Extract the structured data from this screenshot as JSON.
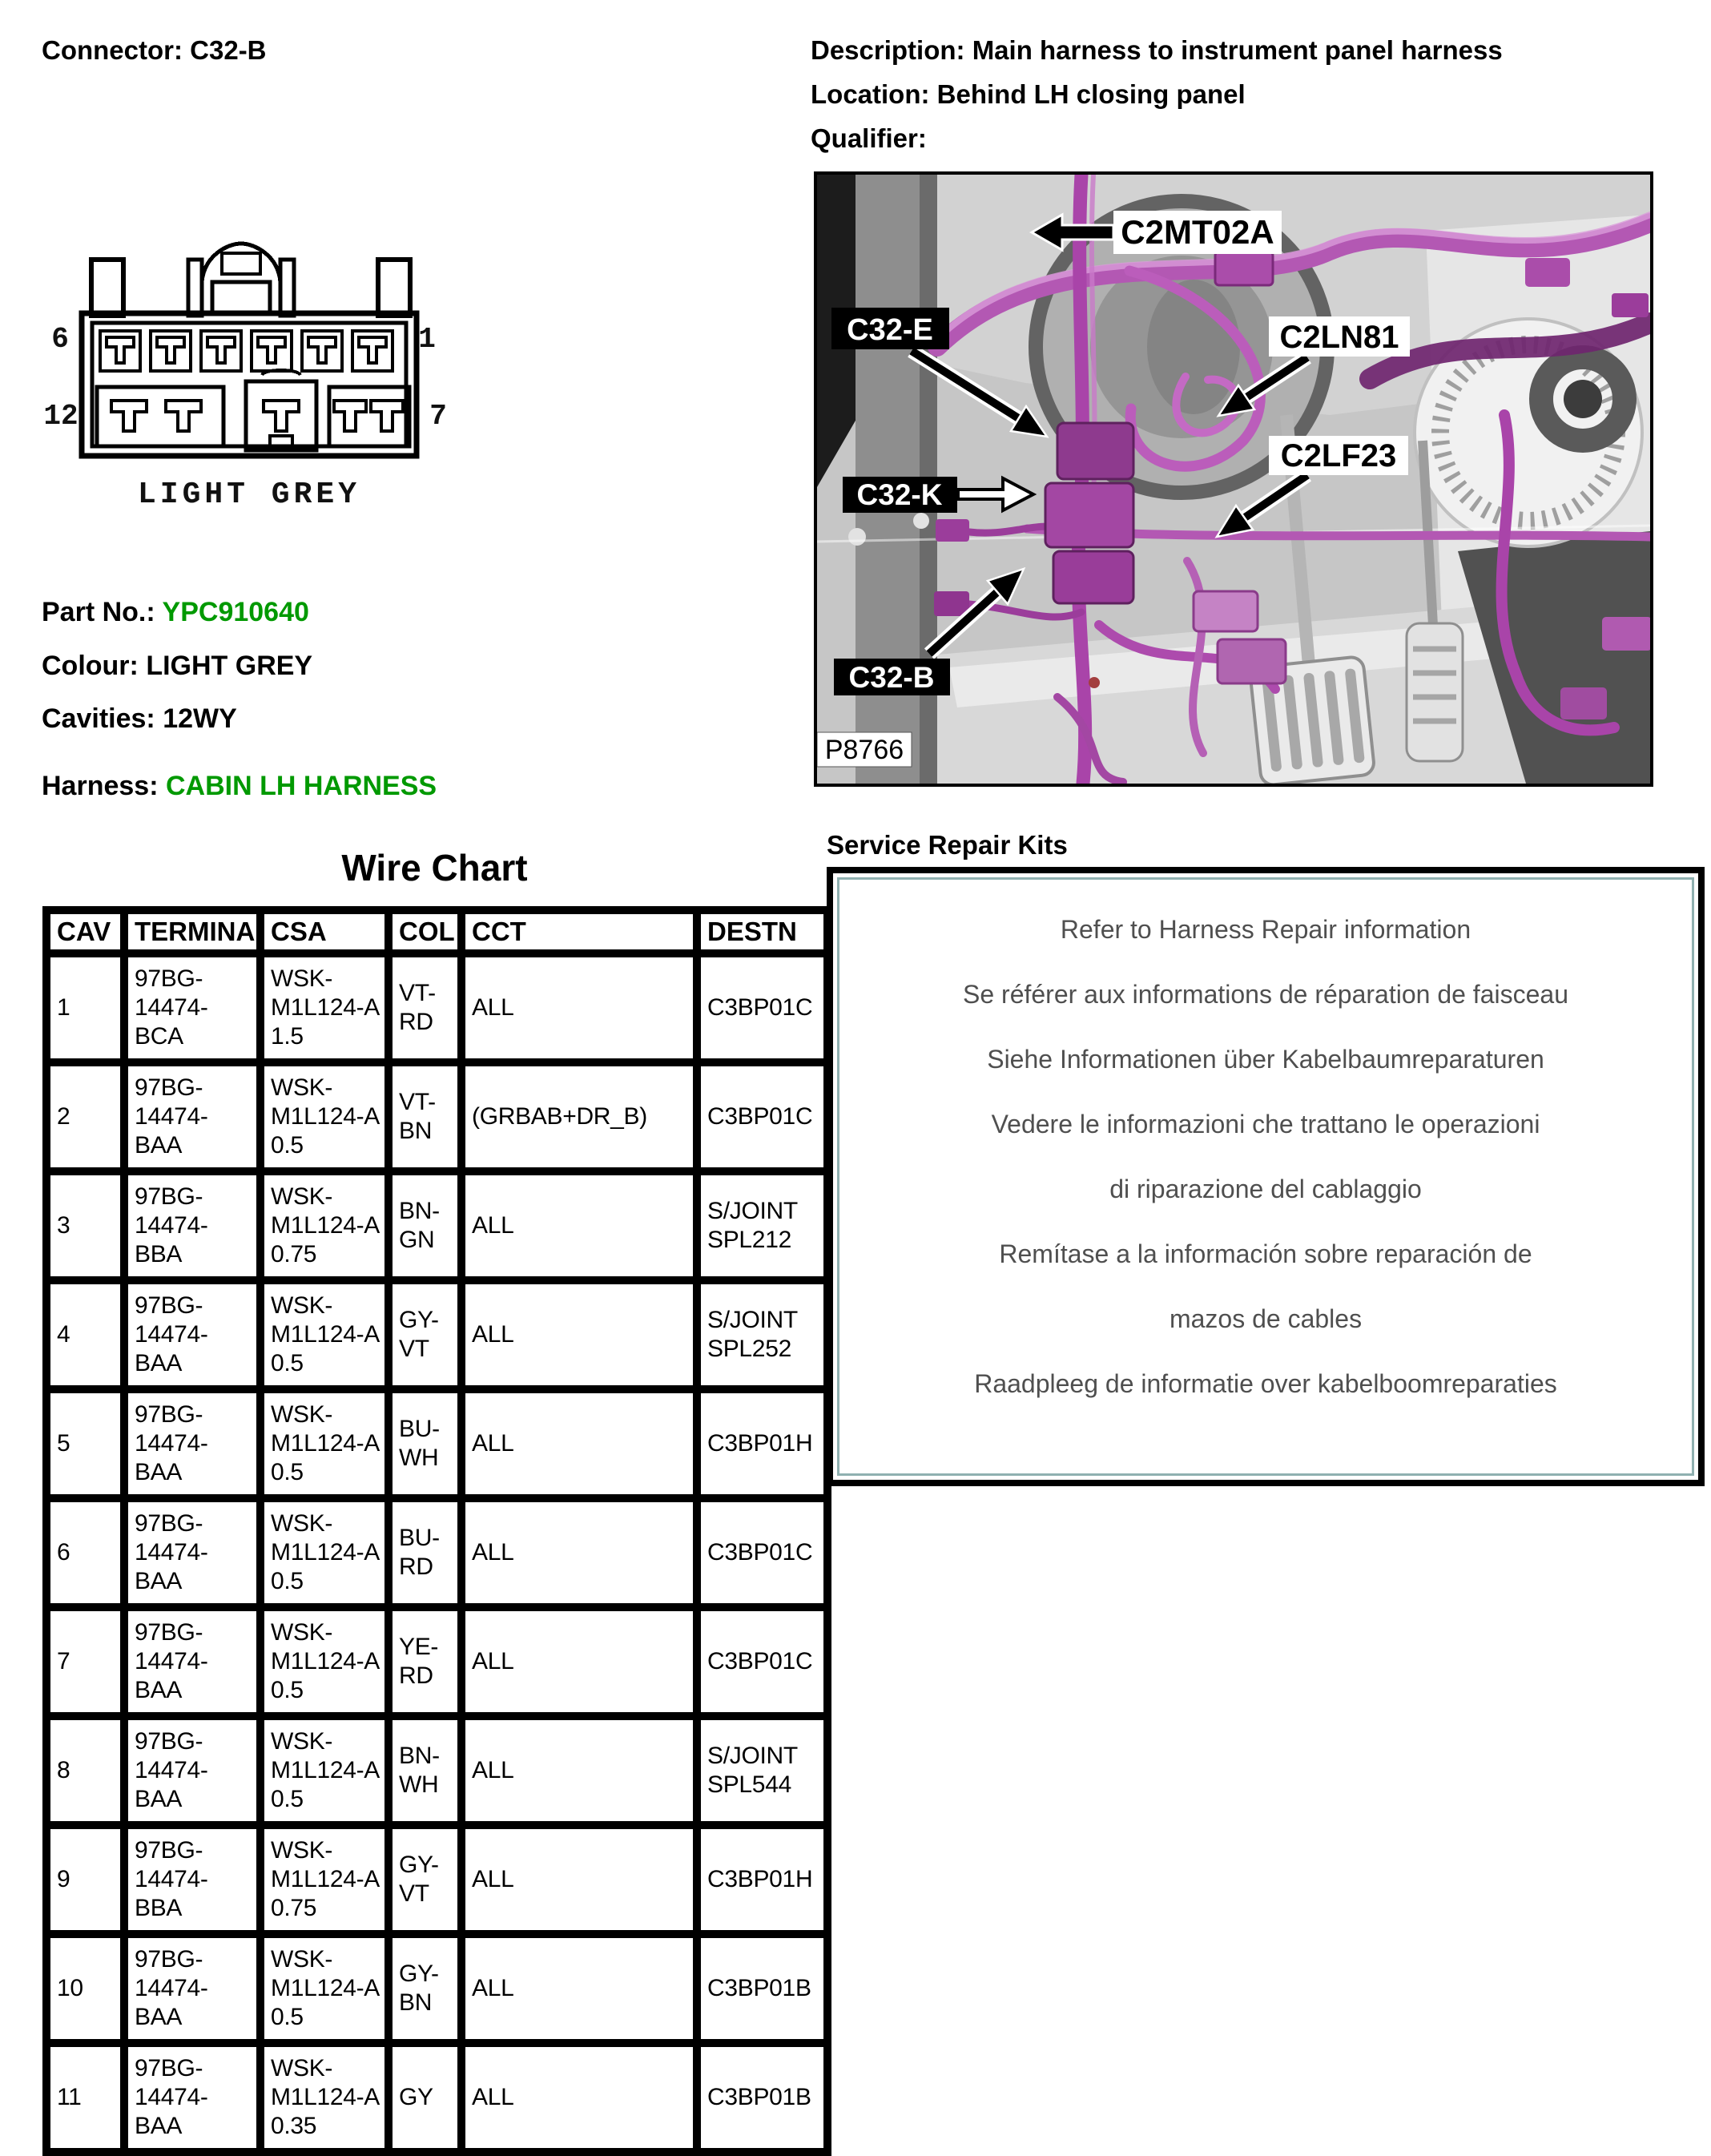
{
  "header": {
    "connector": "Connector: C32-B",
    "description": "Description: Main harness to instrument panel harness",
    "location": "Location: Behind LH closing panel",
    "qualifier": "Qualifier:"
  },
  "connector_diagram": {
    "pins": {
      "top_left": "6",
      "top_right": "1",
      "bottom_left": "12",
      "bottom_right": "7"
    },
    "colour": "LIGHT GREY"
  },
  "part_info": {
    "part_label": "Part No.:",
    "part_value": "YPC910640",
    "colour_label": "Colour:",
    "colour_value": "LIGHT GREY",
    "cavities_label": "Cavities:",
    "cavities_value": "12WY",
    "harness_label": "Harness:",
    "harness_value": "CABIN LH HARNESS"
  },
  "photo": {
    "figure_id": "P8766",
    "callouts": [
      {
        "label": "C2MT02A"
      },
      {
        "label": "C32-E"
      },
      {
        "label": "C2LN81"
      },
      {
        "label": "C2LF23"
      },
      {
        "label": "C32-K"
      },
      {
        "label": "C32-B"
      }
    ]
  },
  "wire_chart": {
    "title": "Wire Chart",
    "headers": [
      "CAV",
      "TERMINAL",
      "CSA",
      "COL",
      "CCT",
      "DESTN"
    ],
    "rows": [
      [
        "1",
        "97BG-14474-BCA",
        "WSK-M1L124-A 1.5",
        "VT-RD",
        "ALL",
        "C3BP01C"
      ],
      [
        "2",
        "97BG-14474-BAA",
        "WSK-M1L124-A 0.5",
        "VT-BN",
        "(GRBAB+DR_B)",
        "C3BP01C"
      ],
      [
        "3",
        "97BG-14474-BBA",
        "WSK-M1L124-A 0.75",
        "BN-GN",
        "ALL",
        "S/JOINT SPL212"
      ],
      [
        "4",
        "97BG-14474-BAA",
        "WSK-M1L124-A 0.5",
        "GY-VT",
        "ALL",
        "S/JOINT SPL252"
      ],
      [
        "5",
        "97BG-14474-BAA",
        "WSK-M1L124-A 0.5",
        "BU-WH",
        "ALL",
        "C3BP01H"
      ],
      [
        "6",
        "97BG-14474-BAA",
        "WSK-M1L124-A 0.5",
        "BU-RD",
        "ALL",
        "C3BP01C"
      ],
      [
        "7",
        "97BG-14474-BAA",
        "WSK-M1L124-A 0.5",
        "YE-RD",
        "ALL",
        "C3BP01C"
      ],
      [
        "8",
        "97BG-14474-BAA",
        "WSK-M1L124-A 0.5",
        "BN-WH",
        "ALL",
        "S/JOINT SPL544"
      ],
      [
        "9",
        "97BG-14474-BBA",
        "WSK-M1L124-A 0.75",
        "GY-VT",
        "ALL",
        "C3BP01H"
      ],
      [
        "10",
        "97BG-14474-BAA",
        "WSK-M1L124-A 0.5",
        "GY-BN",
        "ALL",
        "C3BP01B"
      ],
      [
        "11",
        "97BG-14474-BAA",
        "WSK-M1L124-A 0.35",
        "GY",
        "ALL",
        "C3BP01B"
      ]
    ]
  },
  "service_kits": {
    "title": "Service Repair Kits",
    "lines": [
      "Refer to Harness Repair information",
      "Se référer aux informations de réparation de faisceau",
      "Siehe Informationen über Kabelbaumreparaturen",
      "Vedere le informazioni che trattano le operazioni",
      "di riparazione del cablaggio",
      "Remítase a la información sobre reparación de",
      "mazos de cables",
      "Raadpleeg de informatie over kabelboomreparaties"
    ]
  },
  "colors": {
    "accent_green": "#009900",
    "service_text_grey": "#4f4f4f",
    "service_inner_border": "#8fb0b0",
    "harness_magenta": "#b358b3",
    "connector_colour": "LIGHT GREY"
  }
}
